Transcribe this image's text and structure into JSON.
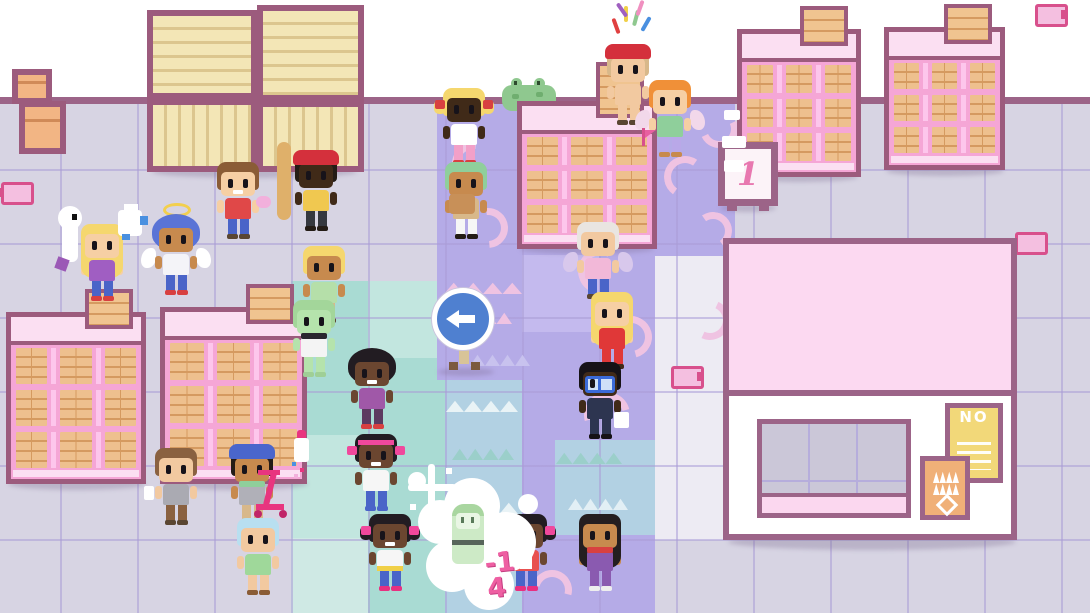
{
  "labels": {
    "rank_sign": "1",
    "poster_no": "NO",
    "score_popup": "-14"
  },
  "scene": {
    "arrow_sign_direction": "left",
    "colors": {
      "wall": "#ffffff",
      "wall_line": "#9c6488",
      "floor": "#d7d4e3",
      "path_purple": "#b5abe7",
      "tile_teal": "#a9dbd3",
      "tile_blue": "#b2d1e3",
      "shelf_pink": "#f5a6d6",
      "shelf_border": "#9c5b7d",
      "crate_wood": "#f3e6b6",
      "roof_pink": "#fcd9f1",
      "poster_yellow": "#f2d879",
      "poster_orange": "#f0b078",
      "sign_blue": "#4f80d0",
      "flag_pink": "#f4bfe0",
      "score_pink": "#ee5fa2"
    },
    "shelves": [
      {
        "x": 6,
        "y": 312,
        "w": 140,
        "h": 172,
        "crateH": 40
      },
      {
        "x": 160,
        "y": 307,
        "w": 147,
        "h": 177,
        "crateH": 40
      },
      {
        "x": 517,
        "y": 101,
        "w": 140,
        "h": 148,
        "crateH": 56
      },
      {
        "x": 737,
        "y": 29,
        "w": 124,
        "h": 148,
        "crateH": 40
      },
      {
        "x": 884,
        "y": 27,
        "w": 121,
        "h": 143,
        "crateH": 40
      }
    ],
    "crates": [
      {
        "x": 147,
        "y": 10,
        "w": 110,
        "h": 89,
        "dir": "h"
      },
      {
        "x": 257,
        "y": 5,
        "w": 107,
        "h": 96,
        "dir": "h"
      },
      {
        "x": 147,
        "y": 99,
        "w": 110,
        "h": 73,
        "dir": "v"
      },
      {
        "x": 257,
        "y": 101,
        "w": 107,
        "h": 71,
        "dir": "v"
      },
      {
        "x": 12,
        "y": 69,
        "w": 40,
        "h": 35,
        "dir": "p"
      },
      {
        "x": 19,
        "y": 101,
        "w": 47,
        "h": 53,
        "dir": "p"
      }
    ],
    "flags": [
      {
        "x": -4,
        "y": 180,
        "pole": "left"
      },
      {
        "x": 666,
        "y": 364,
        "pole": "right"
      },
      {
        "x": 1010,
        "y": 230,
        "pole": "left"
      },
      {
        "x": 1030,
        "y": 2,
        "pole": "right"
      }
    ],
    "swirls": [
      {
        "x": 452,
        "y": 142,
        "s": 30,
        "rot": -40
      },
      {
        "x": 468,
        "y": 208,
        "s": 26,
        "rot": 130
      },
      {
        "x": 578,
        "y": 248,
        "s": 32,
        "rot": -20
      },
      {
        "x": 610,
        "y": 316,
        "s": 28,
        "rot": 120
      },
      {
        "x": 584,
        "y": 392,
        "s": 32,
        "rot": 30
      },
      {
        "x": 664,
        "y": 156,
        "s": 28,
        "rot": -10
      },
      {
        "x": 694,
        "y": 212,
        "s": 24,
        "rot": 100
      },
      {
        "x": 700,
        "y": 110,
        "s": 24,
        "rot": 200
      },
      {
        "x": 690,
        "y": 300,
        "s": 26,
        "rot": 160
      },
      {
        "x": 532,
        "y": 570,
        "s": 26,
        "rot": 60
      }
    ],
    "clouds": [
      {
        "x": 444,
        "y": 280,
        "w": 78,
        "c": "#efc3e2"
      },
      {
        "x": 450,
        "y": 310,
        "w": 62,
        "c": "#efc3e2"
      },
      {
        "x": 446,
        "y": 398,
        "w": 72,
        "c": "#e9f3f6"
      },
      {
        "x": 452,
        "y": 446,
        "w": 62,
        "c": "#9bcfca"
      },
      {
        "x": 444,
        "y": 500,
        "w": 74,
        "c": "#e9f3f6"
      },
      {
        "x": 450,
        "y": 548,
        "w": 60,
        "c": "#9bcfca"
      },
      {
        "x": 556,
        "y": 450,
        "w": 66,
        "c": "#9bcfca"
      },
      {
        "x": 568,
        "y": 496,
        "w": 60,
        "c": "#e2eff5"
      },
      {
        "x": 470,
        "y": 352,
        "w": 60,
        "c": "#c8c2ee"
      }
    ],
    "shadows": [
      {
        "x": 152,
        "y": 166,
        "w": 205,
        "h": 12
      },
      {
        "x": 8,
        "y": 478,
        "w": 138,
        "h": 12
      },
      {
        "x": 162,
        "y": 478,
        "w": 146,
        "h": 12
      },
      {
        "x": 520,
        "y": 244,
        "w": 134,
        "h": 10
      },
      {
        "x": 740,
        "y": 172,
        "w": 118,
        "h": 10
      },
      {
        "x": 886,
        "y": 166,
        "w": 118,
        "h": 10
      },
      {
        "x": 728,
        "y": 534,
        "w": 288,
        "h": 16
      },
      {
        "x": 438,
        "y": 368,
        "w": 56,
        "h": 8
      },
      {
        "x": 720,
        "y": 204,
        "w": 56,
        "h": 8
      }
    ]
  },
  "characters": [
    {
      "name": "blonde-girl",
      "x": 76,
      "y": 222,
      "features": "hair-long",
      "colors": {
        "skin": "#f6cfa4",
        "hair": "#f5d76e",
        "shirt": "#a05ec2",
        "pants": "#4a64c8",
        "shoe": "#d84040"
      }
    },
    {
      "name": "blue-angel",
      "x": 150,
      "y": 216,
      "features": "hair-afro has-halo has-wings",
      "colors": {
        "skin": "#c78a4e",
        "hair": "#5a74d6",
        "shirt": "#f4f4f8",
        "pants": "#4a64c8",
        "shoe": "#d84040",
        "wing": "#ffffff"
      }
    },
    {
      "name": "overalls-kid",
      "x": 212,
      "y": 160,
      "features": "grin",
      "colors": {
        "skin": "#f6cfa4",
        "hair": "#8a5c36",
        "shirt": "#e04848",
        "pants": "#4a64c8",
        "shoe": "#5a4632"
      },
      "item": {
        "x": 44,
        "y": 36,
        "w": 15,
        "h": 12,
        "color": "#f2b0dc",
        "r": 6
      }
    },
    {
      "name": "beret-baguette-kid",
      "x": 290,
      "y": 152,
      "features": "has-hat",
      "colors": {
        "skin": "#402a18",
        "hair": "#241c16",
        "hat": "#d4303c",
        "shirt": "#f0c850",
        "pants": "#35383f",
        "shoe": "#241c16"
      },
      "item": {
        "x": -13,
        "y": -10,
        "w": 14,
        "h": 78,
        "color": "#dfb06a",
        "r": 7
      }
    },
    {
      "name": "blonde-bob-kid",
      "x": 298,
      "y": 244,
      "features": "",
      "colors": {
        "skin": "#c78a4e",
        "hair": "#f5d76e",
        "shirt": "#b5dfa9",
        "pants": "#d8b88a",
        "shoe": "#5a4632"
      }
    },
    {
      "name": "zombie-kid",
      "x": 288,
      "y": 298,
      "features": "has-scarf",
      "colors": {
        "skin": "#b5e3ac",
        "hair": "#a3d69a",
        "shirt": "#f4f4f4",
        "pants": "#b5e3ac",
        "shoe": "#9fcf96",
        "scarf": "#2a262e"
      }
    },
    {
      "name": "afro-girl",
      "x": 346,
      "y": 350,
      "features": "hair-afro grin",
      "colors": {
        "skin": "#6b4630",
        "hair": "#221c22",
        "shirt": "#a058a8",
        "pants": "#5c3a60",
        "shoe": "#d84040"
      }
    },
    {
      "name": "headband-girl",
      "x": 350,
      "y": 432,
      "features": "has-headband has-bows grin",
      "colors": {
        "skin": "#6b4630",
        "hair": "#221c22",
        "shirt": "#f6f6f6",
        "pants": "#4a64c8",
        "shoe": "#4a64c8",
        "bow": "#f0489c"
      }
    },
    {
      "name": "pigtails-girl",
      "x": 364,
      "y": 512,
      "features": "pigtails has-bows grin",
      "colors": {
        "skin": "#6b4630",
        "hair": "#221c22",
        "shirt": "#f6f6f6",
        "pants": "#4a64c8",
        "shoe": "#e83080",
        "bow": "#f0489c"
      },
      "item": {
        "x": 13,
        "y": 54,
        "w": 26,
        "h": 5,
        "color": "#f0d048"
      }
    },
    {
      "name": "bow-girl",
      "x": 500,
      "y": 512,
      "features": "pigtails has-bows grin",
      "colors": {
        "skin": "#6b4630",
        "hair": "#221c22",
        "shirt": "#e85050",
        "pants": "#4a64c8",
        "shoe": "#e83080",
        "bow": "#f0489c"
      },
      "item": {
        "x": 20,
        "y": 38,
        "w": 12,
        "h": 19,
        "color": "#ffffff"
      }
    },
    {
      "name": "scarf-girl",
      "x": 574,
      "y": 512,
      "features": "hair-long has-scarf",
      "colors": {
        "skin": "#c78a4e",
        "hair": "#241e20",
        "shirt": "#8a5ab0",
        "pants": "#8a5ab0",
        "shoe": "#eeeeee",
        "scarf": "#d84040"
      }
    },
    {
      "name": "grandma",
      "x": 572,
      "y": 220,
      "features": "has-wings",
      "colors": {
        "skin": "#f2c9a0",
        "hair": "#e9e5e1",
        "shirt": "#f2b8d8",
        "pants": "#4a64c8",
        "shoe": "#5a4632",
        "wing": "#d8c8ec"
      }
    },
    {
      "name": "red-dress-woman",
      "x": 586,
      "y": 290,
      "features": "hair-long",
      "colors": {
        "skin": "#f6cfa4",
        "hair": "#f5d76e",
        "shirt": "#e03838",
        "pants": "#e03838",
        "shoe": "#402a18"
      }
    },
    {
      "name": "glasses-man",
      "x": 574,
      "y": 360,
      "features": "has-glasses",
      "colors": {
        "skin": "#402a18",
        "hair": "#161216",
        "shirt": "#2d3550",
        "pants": "#2d3550",
        "shoe": "#161216"
      },
      "item": {
        "x": 40,
        "y": 52,
        "w": 15,
        "h": 16,
        "color": "#ffffff",
        "r": 2
      }
    },
    {
      "name": "pigtail-blonde-girl",
      "x": 438,
      "y": 86,
      "features": "pigtails has-bows",
      "colors": {
        "skin": "#402a18",
        "hair": "#f5d76e",
        "shirt": "#ffffff",
        "pants": "#f2a0c8",
        "shoe": "#d84040",
        "bow": "#d84040"
      }
    },
    {
      "name": "carrier-kid",
      "x": 440,
      "y": 160,
      "features": "",
      "colors": {
        "skin": "#c78a4e",
        "hair": "#8fcf9b",
        "shirt": "#d8b88a",
        "pants": "#f6f6f6",
        "shoe": "#241c16"
      },
      "item": {
        "x": 9,
        "y": 34,
        "w": 26,
        "h": 20,
        "color": "#c89058",
        "r": 4
      }
    },
    {
      "name": "party-kid",
      "x": 602,
      "y": 46,
      "z": 4,
      "features": "has-hat",
      "colors": {
        "skin": "#f2c9a0",
        "hair": "#d8b88a",
        "hat": "#d4303c",
        "shirt": "#f2c9a0",
        "pants": "#f2c9a0",
        "shoe": "#5a4632"
      }
    },
    {
      "name": "orange-fairy",
      "x": 644,
      "y": 78,
      "features": "has-wings",
      "colors": {
        "skin": "#f6cfa4",
        "hair": "#f09038",
        "shirt": "#8fcf9b",
        "pants": "#b9a8e8",
        "shoe": "#c78a4e",
        "wing": "#f2d8ea"
      }
    },
    {
      "name": "slingshot-kid",
      "x": 150,
      "y": 446,
      "features": "",
      "colors": {
        "skin": "#f2c9a0",
        "hair": "#8a6140",
        "shirt": "#aaaab2",
        "pants": "#8a6140",
        "shoe": "#5a4632"
      },
      "item": {
        "x": -6,
        "y": 40,
        "w": 10,
        "h": 14,
        "color": "#ffffff",
        "r": 2
      }
    },
    {
      "name": "cap-kid",
      "x": 226,
      "y": 446,
      "features": "has-hat has-scarf",
      "colors": {
        "skin": "#c78a4e",
        "hair": "#241c16",
        "hat": "#4a66cc",
        "shirt": "#b0b0b8",
        "pants": "#d8b88a",
        "shoe": "#402a18",
        "scarf": "#8fcf9b"
      }
    },
    {
      "name": "mint-kid",
      "x": 232,
      "y": 516,
      "features": "",
      "colors": {
        "skin": "#f2c9a0",
        "hair": "#b8dff0",
        "shirt": "#9fd89a",
        "pants": "#f2c9a0",
        "shoe": "#8a5c36"
      }
    }
  ]
}
